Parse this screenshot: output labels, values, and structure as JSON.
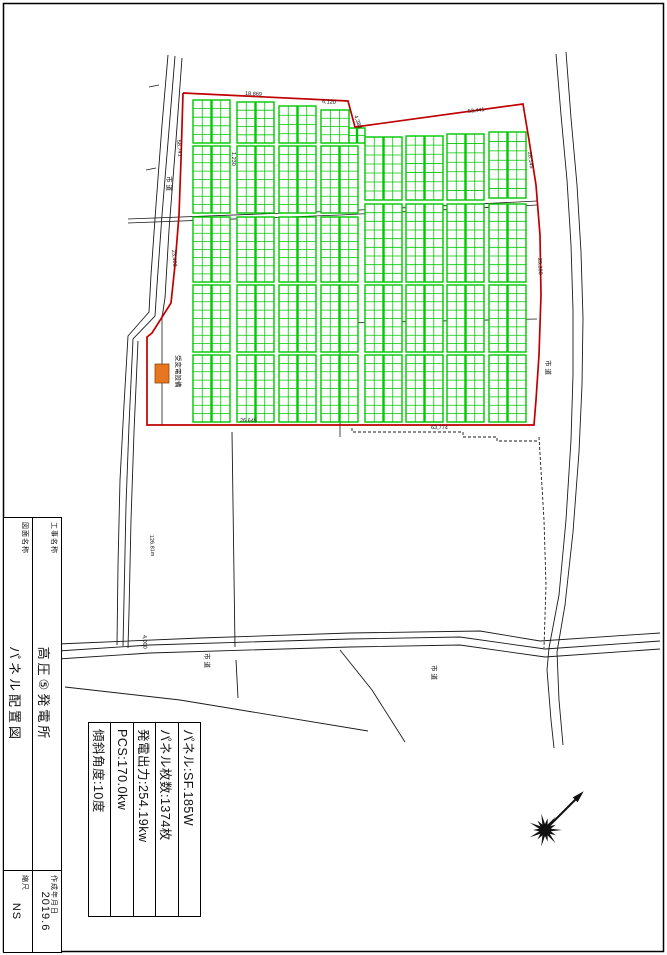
{
  "title_block": {
    "project_label": "工事名称",
    "project_name": "高圧⑤発電所",
    "date_label": "作成年月日",
    "date_value": "2019.6",
    "drawing_label": "図面名称",
    "drawing_name": "パネル配置図",
    "scale_label": "縮尺",
    "scale_value": "NS"
  },
  "spec_table": {
    "rows": [
      "パネル:SF.185W",
      "パネル枚数:1374枚",
      "発電出力:254.19kw",
      "PCS:170.0kw",
      "傾斜角度:10度"
    ]
  },
  "plan": {
    "colors": {
      "panel": "#00c800",
      "boundary": "#c00000",
      "equipment": "#e8761e",
      "line": "#1a1a1a",
      "border": "#000000"
    },
    "equipment_label": "受変電設備",
    "equipment_rect": [
      155,
      364,
      14,
      19
    ],
    "boundary": [
      [
        183,
        93
      ],
      [
        348,
        101
      ],
      [
        355,
        127
      ],
      [
        523,
        104
      ],
      [
        529,
        140
      ],
      [
        536,
        185
      ],
      [
        540,
        235
      ],
      [
        541,
        295
      ],
      [
        539,
        355
      ],
      [
        536,
        400
      ],
      [
        534,
        425
      ],
      [
        147,
        425
      ],
      [
        147,
        337
      ],
      [
        152,
        333
      ],
      [
        171,
        303
      ],
      [
        175,
        265
      ],
      [
        179,
        215
      ],
      [
        181,
        160
      ],
      [
        183,
        93
      ]
    ],
    "panel_blocks": [
      [
        193,
        100,
        37,
        43,
        4,
        5
      ],
      [
        193,
        146,
        37,
        67,
        4,
        8
      ],
      [
        193,
        217,
        37,
        65,
        4,
        8
      ],
      [
        193,
        285,
        37,
        67,
        4,
        8
      ],
      [
        193,
        355,
        37,
        67,
        4,
        8
      ],
      [
        237,
        102,
        37,
        41,
        4,
        5
      ],
      [
        237,
        146,
        37,
        67,
        4,
        8
      ],
      [
        237,
        217,
        37,
        65,
        4,
        8
      ],
      [
        237,
        285,
        37,
        67,
        4,
        8
      ],
      [
        237,
        355,
        37,
        67,
        4,
        8
      ],
      [
        279,
        106,
        37,
        37,
        4,
        4
      ],
      [
        279,
        146,
        37,
        67,
        4,
        8
      ],
      [
        279,
        217,
        37,
        65,
        4,
        8
      ],
      [
        279,
        285,
        37,
        67,
        4,
        8
      ],
      [
        279,
        355,
        37,
        67,
        4,
        8
      ],
      [
        321,
        110,
        28,
        33,
        3,
        4
      ],
      [
        349,
        128,
        16,
        15,
        2,
        2
      ],
      [
        321,
        146,
        37,
        67,
        4,
        8
      ],
      [
        321,
        217,
        37,
        65,
        4,
        8
      ],
      [
        321,
        285,
        37,
        67,
        4,
        8
      ],
      [
        321,
        355,
        37,
        67,
        4,
        8
      ],
      [
        365,
        137,
        37,
        63,
        4,
        7
      ],
      [
        365,
        204,
        37,
        78,
        4,
        9
      ],
      [
        365,
        285,
        37,
        67,
        4,
        8
      ],
      [
        365,
        355,
        37,
        67,
        4,
        8
      ],
      [
        406,
        136,
        37,
        64,
        4,
        7
      ],
      [
        406,
        204,
        37,
        78,
        4,
        9
      ],
      [
        406,
        285,
        37,
        67,
        4,
        8
      ],
      [
        406,
        355,
        37,
        67,
        4,
        8
      ],
      [
        447,
        134,
        37,
        66,
        4,
        7
      ],
      [
        447,
        204,
        37,
        78,
        4,
        9
      ],
      [
        447,
        285,
        37,
        67,
        4,
        8
      ],
      [
        447,
        355,
        37,
        67,
        4,
        8
      ],
      [
        489,
        132,
        37,
        66,
        4,
        7
      ],
      [
        489,
        204,
        37,
        78,
        4,
        9
      ],
      [
        489,
        285,
        37,
        67,
        4,
        8
      ],
      [
        489,
        355,
        37,
        67,
        4,
        8
      ]
    ],
    "roads": [
      [
        [
          168,
          55
        ],
        [
          162,
          125
        ],
        [
          156,
          205
        ],
        [
          151,
          275
        ],
        [
          149,
          312
        ],
        [
          128,
          336
        ],
        [
          124,
          405
        ],
        [
          120,
          480
        ],
        [
          118,
          565
        ],
        [
          117,
          645
        ]
      ],
      [
        [
          175,
          56
        ],
        [
          169,
          130
        ],
        [
          162,
          215
        ],
        [
          157,
          285
        ],
        [
          155,
          316
        ],
        [
          133,
          339
        ],
        [
          129,
          425
        ],
        [
          126,
          505
        ],
        [
          124,
          600
        ],
        [
          123,
          646
        ]
      ],
      [
        [
          182,
          58
        ],
        [
          176,
          140
        ],
        [
          169,
          230
        ],
        [
          165,
          298
        ],
        [
          162,
          318
        ]
      ],
      [
        [
          138,
          341
        ],
        [
          134,
          432
        ],
        [
          131,
          520
        ],
        [
          129,
          612
        ],
        [
          128,
          648
        ]
      ],
      [
        [
          556,
          54
        ],
        [
          561,
          115
        ],
        [
          567,
          180
        ],
        [
          571,
          245
        ],
        [
          573,
          310
        ],
        [
          573,
          375
        ],
        [
          571,
          440
        ],
        [
          566,
          520
        ],
        [
          559,
          595
        ],
        [
          549,
          648
        ],
        [
          547,
          670
        ],
        [
          551,
          720
        ],
        [
          554,
          748
        ]
      ],
      [
        [
          566,
          52
        ],
        [
          571,
          118
        ],
        [
          577,
          185
        ],
        [
          581,
          252
        ],
        [
          583,
          318
        ],
        [
          582,
          385
        ],
        [
          579,
          452
        ],
        [
          573,
          532
        ],
        [
          565,
          605
        ],
        [
          557,
          652
        ],
        [
          559,
          700
        ],
        [
          563,
          745
        ]
      ],
      [
        [
          58,
          651
        ],
        [
          150,
          645
        ],
        [
          350,
          639
        ],
        [
          460,
          637
        ],
        [
          545,
          649
        ],
        [
          660,
          641
        ]
      ],
      [
        [
          58,
          659
        ],
        [
          150,
          653
        ],
        [
          350,
          647
        ],
        [
          460,
          645
        ],
        [
          545,
          657
        ],
        [
          660,
          649
        ]
      ],
      [
        [
          58,
          644
        ],
        [
          200,
          638
        ],
        [
          350,
          633
        ],
        [
          480,
          631
        ],
        [
          540,
          641
        ],
        [
          660,
          633
        ]
      ],
      [
        [
          65,
          687
        ],
        [
          180,
          700
        ],
        [
          368,
          731
        ]
      ],
      [
        [
          340,
          650
        ],
        [
          372,
          690
        ],
        [
          405,
          742
        ]
      ],
      [
        [
          236,
          660
        ],
        [
          238,
          698
        ]
      ],
      [
        [
          232,
          432
        ],
        [
          235,
          647
        ]
      ]
    ],
    "internal_lines": [
      [
        [
          128,
          219
        ],
        [
          340,
          211
        ],
        [
          537,
          201
        ]
      ],
      [
        [
          128,
          223
        ],
        [
          340,
          215
        ],
        [
          537,
          205
        ]
      ],
      [
        [
          340,
          323
        ],
        [
          537,
          319
        ]
      ],
      [
        [
          340,
          323
        ],
        [
          340,
          437
        ]
      ],
      [
        [
          162,
          315
        ],
        [
          162,
          364
        ]
      ],
      [
        [
          162,
          383
        ],
        [
          162,
          425
        ]
      ]
    ],
    "dashed_lines": [
      [
        [
          352,
          428
        ],
        [
          352,
          432
        ],
        [
          463,
          432
        ],
        [
          463,
          437
        ],
        [
          497,
          437
        ],
        [
          497,
          441
        ],
        [
          538,
          441
        ]
      ],
      [
        [
          539,
          437
        ],
        [
          544,
          520
        ],
        [
          546,
          585
        ],
        [
          544,
          648
        ]
      ]
    ],
    "dimensions": [
      {
        "t": "18,869",
        "x": 245,
        "y": 95,
        "r": 3
      },
      {
        "t": "6,120",
        "x": 322,
        "y": 103,
        "r": 4
      },
      {
        "t": "4,383",
        "x": 354,
        "y": 116,
        "r": 70
      },
      {
        "t": "53,441",
        "x": 468,
        "y": 113,
        "r": -7
      },
      {
        "t": "28,145",
        "x": 528,
        "y": 152,
        "r": 83
      },
      {
        "t": "29,390",
        "x": 538,
        "y": 258,
        "r": 87
      },
      {
        "t": "58,741",
        "x": 177,
        "y": 140,
        "r": 85
      },
      {
        "t": "23,402",
        "x": 172,
        "y": 250,
        "r": 85
      },
      {
        "t": "1,230",
        "x": 232,
        "y": 152,
        "r": 90
      },
      {
        "t": "26,645",
        "x": 240,
        "y": 422,
        "r": 1
      },
      {
        "t": "63,774",
        "x": 431,
        "y": 429,
        "r": 1
      },
      {
        "t": "4,000",
        "x": 143,
        "y": 635,
        "r": 88
      },
      {
        "t": "126.81m",
        "x": 150,
        "y": 535,
        "r": 87
      }
    ],
    "road_labels": [
      {
        "t": "市道",
        "x": 167,
        "y": 176
      },
      {
        "t": "市道",
        "x": 546,
        "y": 360
      },
      {
        "t": "市道",
        "x": 205,
        "y": 653
      },
      {
        "t": "市道",
        "x": 432,
        "y": 665
      }
    ],
    "equipment_label_pos": [
      176,
      355
    ]
  },
  "compass": {
    "cx": 545,
    "cy": 830,
    "ax": 578,
    "ay": 797
  }
}
